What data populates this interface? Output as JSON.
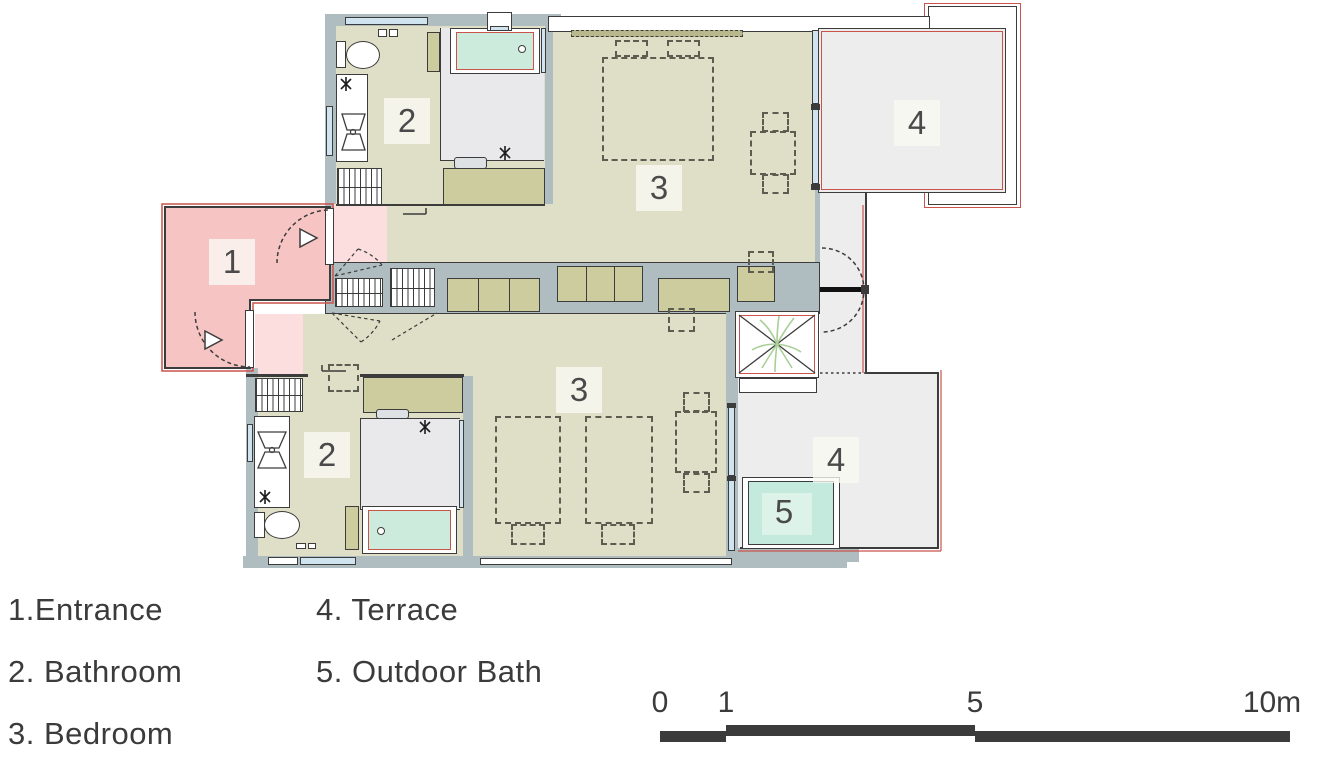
{
  "plan": {
    "labels": {
      "entrance": "1",
      "bathroom_upper": "2",
      "bedroom_upper": "3",
      "terrace_upper": "4",
      "bathroom_lower": "2",
      "bedroom_lower": "3",
      "terrace_lower": "4",
      "outdoor_bath": "5"
    },
    "colors": {
      "wall": "#afbdc1",
      "floor_olive": "#dfdec6",
      "entrance_pink": "#f6c5c3",
      "vestibule_pink": "#fbdedd",
      "shower_gray": "#e9e9ec",
      "terrace_gray": "#ededed",
      "bathtub_mint": "#cdebdc",
      "outdoor_bath_teal": "#c4e9dd",
      "cabinet_olive": "#cccc9e",
      "accent_red": "#c9544b",
      "line_dark": "#3c3c3c",
      "plant_green": "#a8cf96"
    }
  },
  "legend": {
    "items": [
      {
        "label": "1.Entrance"
      },
      {
        "label": "2. Bathroom"
      },
      {
        "label": "3. Bedroom"
      },
      {
        "label": "4. Terrace"
      },
      {
        "label": "5. Outdoor Bath"
      }
    ]
  },
  "scale_bar": {
    "ticks": [
      {
        "label": "0"
      },
      {
        "label": "1"
      },
      {
        "label": "5"
      },
      {
        "label": "10m"
      }
    ]
  }
}
